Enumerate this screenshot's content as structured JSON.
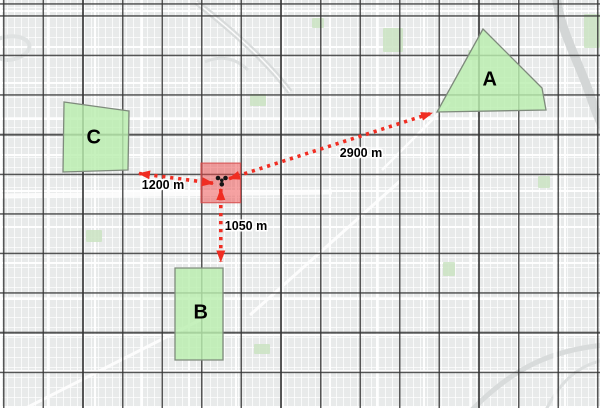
{
  "map": {
    "sites": [
      {
        "label": "A"
      },
      {
        "label": "B"
      },
      {
        "label": "C"
      }
    ],
    "origin": {
      "icon": "trefoil-marker-icon"
    },
    "measurements": [
      {
        "from": "origin",
        "to": "A",
        "label": "2900 m"
      },
      {
        "from": "origin",
        "to": "B",
        "label": "1050 m"
      },
      {
        "from": "origin",
        "to": "C",
        "label": "1200 m"
      }
    ],
    "colors": {
      "site_fill": "#b9eeae",
      "site_stroke": "#7e8a7c",
      "origin_fill": "#ee4646",
      "measurement": "#f02d22",
      "grid_line": "#343434",
      "basemap": "#e8eaea",
      "water": "#d3d6d6"
    }
  }
}
